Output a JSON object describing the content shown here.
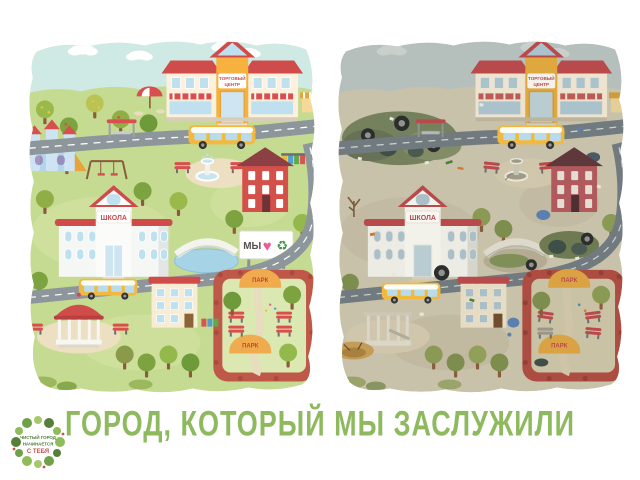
{
  "title": {
    "text": "ГОРОД, КОТОРЫЙ МЫ ЗАСЛУЖИЛИ",
    "color": "#8eb95e"
  },
  "logo": {
    "line1": "ЧИСТЫЙ ГОРОД",
    "line2": "НАЧИНАЕТСЯ",
    "line3": "С ТЕБЯ"
  },
  "left_map": {
    "label": "clean city",
    "mall_sign": [
      "ТОРГОВЫЙ",
      "ЦЕНТР"
    ],
    "school_sign": "ШКОЛА",
    "park_gate_top": "ПАРК",
    "park_gate_inner": "ПАРК",
    "billboard": {
      "we": "МЫ",
      "heart": "♥",
      "recycle": "♻"
    }
  },
  "right_map": {
    "label": "polluted city",
    "mall_sign": [
      "ТОРГОВЫЙ",
      "ЦЕНТР"
    ],
    "school_sign": "ШКОЛА",
    "park_gate_top": "ПАРК",
    "park_gate_inner": "ПАРК"
  },
  "colors": {
    "clean_grass": "#c6db92",
    "clean_sky": "#cfe9e4",
    "dirty_ground": "#c9c2ab",
    "dirty_sky": "#b5bfbc",
    "accent_red": "#cf4b4c",
    "title_green": "#8eb95e"
  }
}
